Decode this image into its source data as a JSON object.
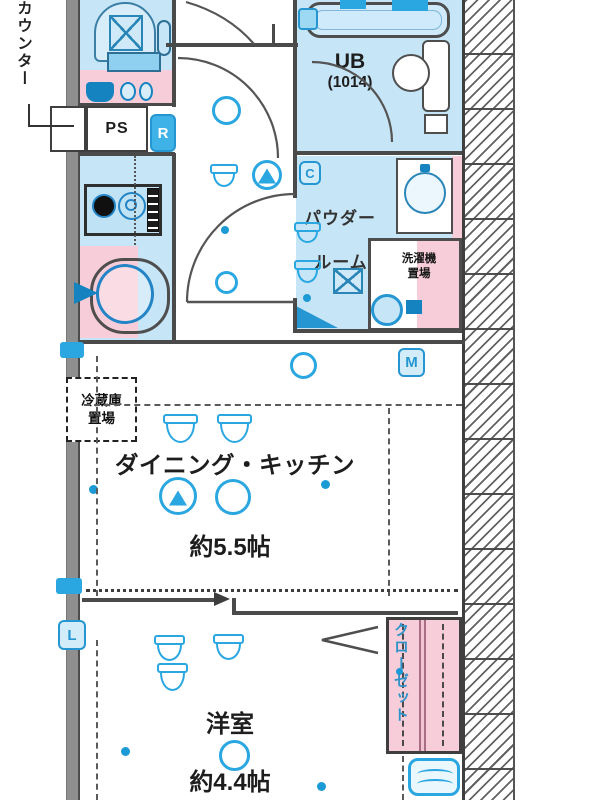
{
  "floorplan": {
    "left_annotation": {
      "counter": "カウンター"
    },
    "rooms": {
      "pipe_space": {
        "label": "PS"
      },
      "unit_bath": {
        "name": "UB",
        "size": "(1014)"
      },
      "powder_room": {
        "name_line1": "パウダー",
        "name_line2": "ルーム"
      },
      "washer_space": {
        "line1": "洗濯機",
        "line2": "置場"
      },
      "fridge_space": {
        "line1": "冷蔵庫",
        "line2": "置場"
      },
      "dining_kitchen": {
        "name": "ダイニング・キッチン",
        "size": "約5.5帖"
      },
      "bedroom": {
        "name": "洋室",
        "size": "約4.4帖"
      },
      "closet": {
        "name": "クローゼット"
      }
    },
    "marks": {
      "refrigerator": "R",
      "meter": "M",
      "c_mark": "C",
      "l_mark": "L"
    },
    "colors": {
      "room_blue": "#c6e6f7",
      "fixture_pink": "#f8cdda",
      "accent_blue": "#2aa7e1",
      "wall_dark": "#4a4a4a",
      "wall_gray": "#8f8f8f"
    }
  }
}
